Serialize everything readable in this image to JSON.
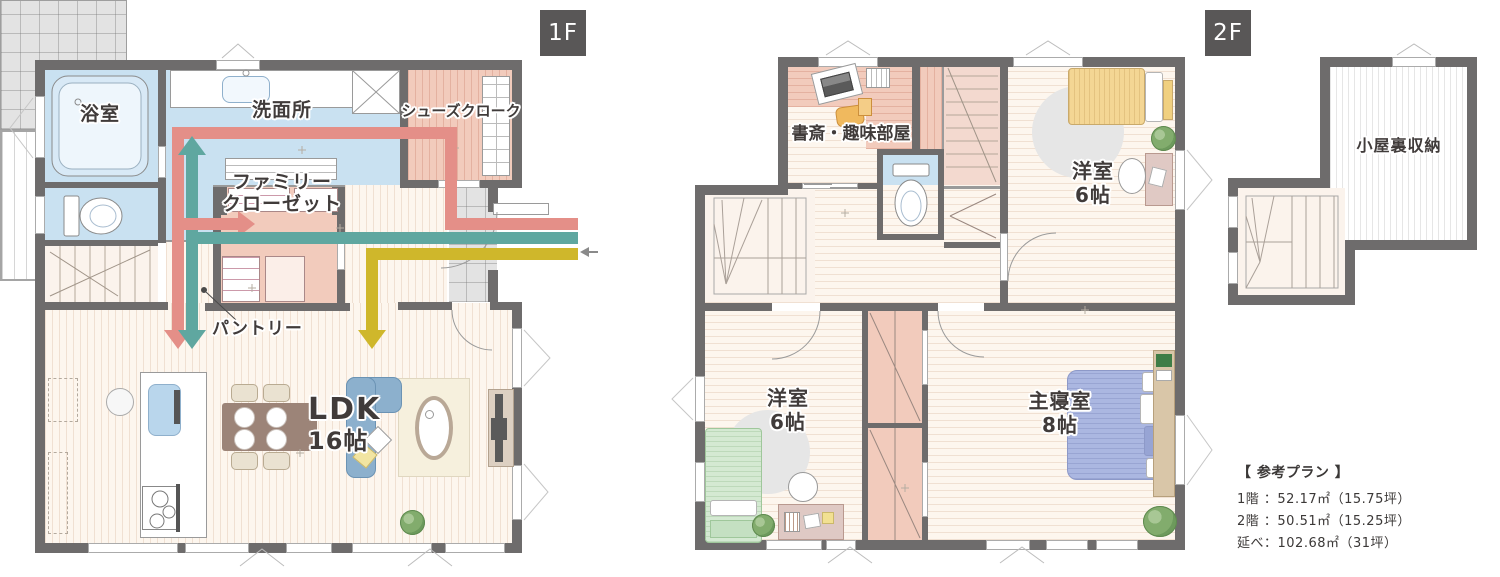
{
  "badges": {
    "f1": "1F",
    "f2": "2F"
  },
  "floor1": {
    "rooms": {
      "bath": "浴室",
      "washroom": "洗面所",
      "shoe_closet": "シューズクローク",
      "family_closet": [
        "ファミリー",
        "クローゼット"
      ],
      "pantry": "パントリー",
      "ldk": [
        "LDK",
        "16帖"
      ]
    }
  },
  "floor2": {
    "rooms": {
      "study": "書斎・趣味部屋",
      "west_room_upper": [
        "洋室",
        "6帖"
      ],
      "west_room_lower": [
        "洋室",
        "6帖"
      ],
      "master_bedroom": [
        "主寝室",
        "8帖"
      ],
      "attic_storage": "小屋裏収納"
    }
  },
  "reference_plan": {
    "title": "【 参考プラン 】",
    "lines": [
      "1階 ：52.17㎡（15.75坪）",
      "2階 ：50.51㎡（15.25坪）",
      "延べ：102.68㎡（31坪）"
    ]
  },
  "flow_arrows": {
    "pink": "#e48f88",
    "teal": "#5fa7a0",
    "yellow": "#cfb72b"
  },
  "colors": {
    "wall": "#6e6c6c",
    "room_blue": "#c9e1f1",
    "room_pink": "#f2cbbc",
    "floor_cream": "#fdf6ee",
    "tile_gray": "#e3e3e3",
    "badge_bg": "#595757"
  }
}
